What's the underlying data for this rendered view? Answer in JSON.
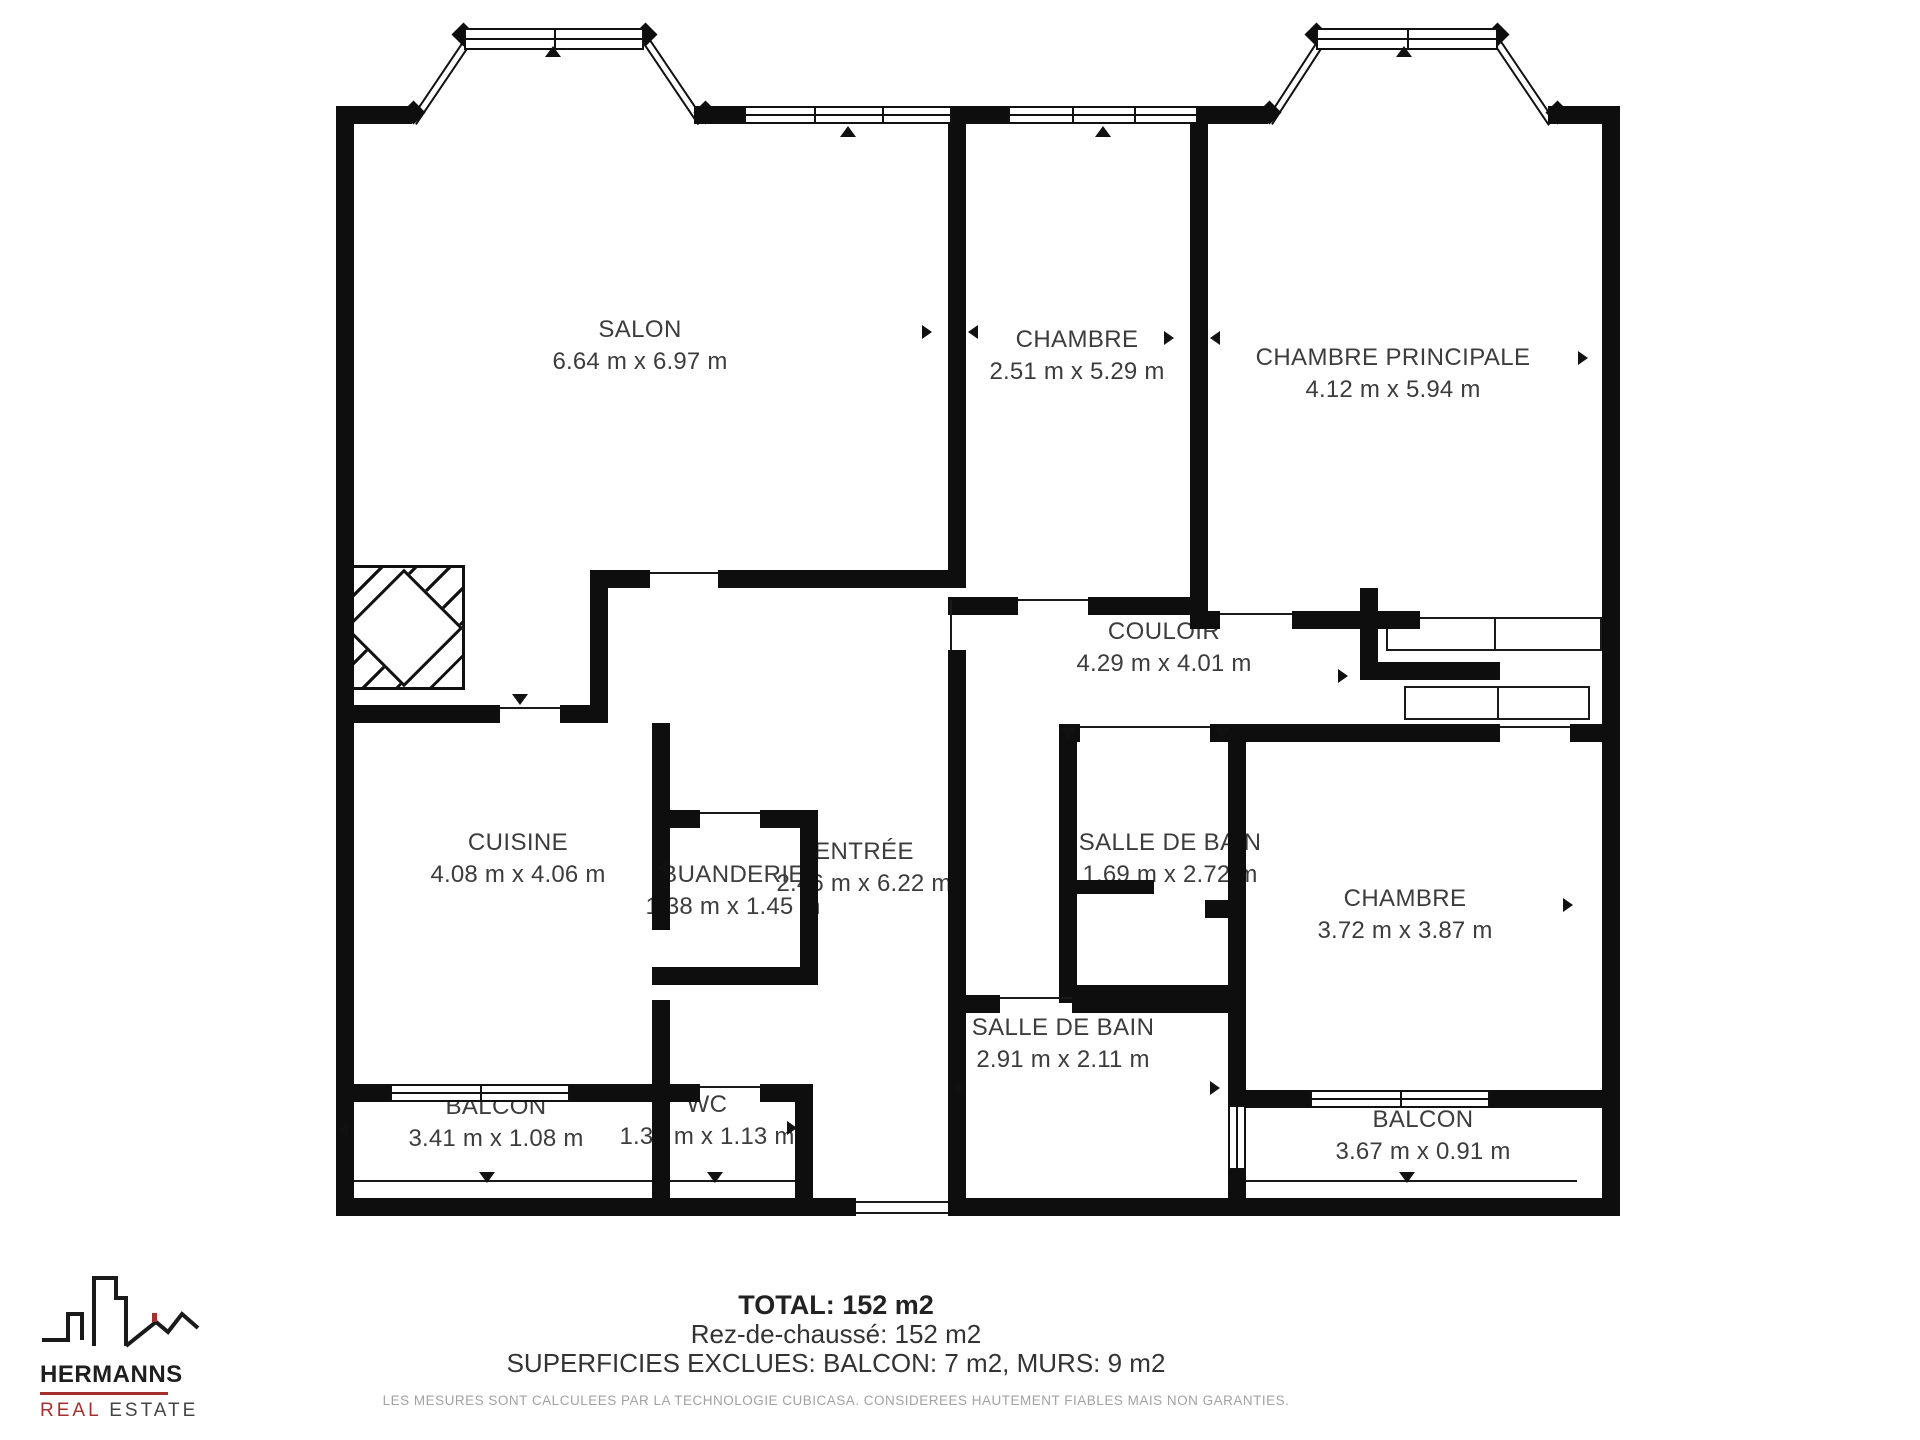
{
  "plan": {
    "rooms": [
      {
        "name": "SALON",
        "dims": "6.64 m x 6.97 m"
      },
      {
        "name": "CHAMBRE",
        "dims": "2.51 m x 5.29 m"
      },
      {
        "name": "CHAMBRE PRINCIPALE",
        "dims": "4.12 m x 5.94 m"
      },
      {
        "name": "COULOIR",
        "dims": "4.29 m x 4.01 m"
      },
      {
        "name": "CUISINE",
        "dims": "4.08 m x 4.06 m"
      },
      {
        "name": "BUANDERIE",
        "dims": "1.38 m x 1.45 m"
      },
      {
        "name": "ENTRÉE",
        "dims": "2.46 m x 6.22 m"
      },
      {
        "name": "SALLE DE BAIN",
        "dims": "1.69 m x 2.72 m"
      },
      {
        "name": "CHAMBRE",
        "dims": "3.72 m x 3.87 m"
      },
      {
        "name": "SALLE DE BAIN",
        "dims": "2.91 m x 2.11 m"
      },
      {
        "name": "WC",
        "dims": "1.39 m x 1.13 m"
      },
      {
        "name": "BALCON",
        "dims": "3.41 m x 1.08 m"
      },
      {
        "name": "BALCON",
        "dims": "3.67 m x 0.91 m"
      }
    ]
  },
  "summary": {
    "total": "TOTAL: 152 m2",
    "floor": "Rez-de-chaussé: 152 m2",
    "excluded": "SUPERFICIES EXCLUES: BALCON: 7 m2, MURS: 9 m2",
    "disclaimer": "LES MESURES SONT CALCULEES PAR LA TECHNOLOGIE CUBICASA. CONSIDEREES HAUTEMENT FIABLES MAIS NON GARANTIES."
  },
  "logo": {
    "name": "HERMANNS",
    "tagline_red": "REAL",
    "tagline_dark": "ESTATE",
    "accent_color": "#A3302E",
    "ink_color": "#1a1a1a"
  }
}
